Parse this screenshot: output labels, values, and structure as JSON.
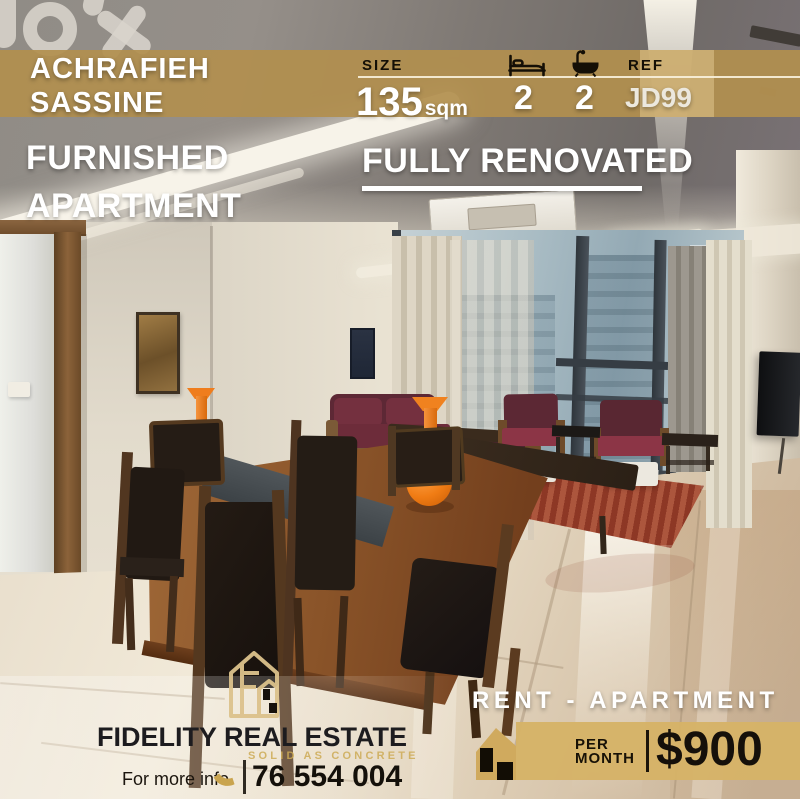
{
  "brand_watermark": "olx",
  "top_banner": {
    "location_line1": "ACHRAFIEH",
    "location_line2": "SASSINE",
    "size_label": "SIZE",
    "size_value": "135",
    "size_unit": "sqm",
    "bedrooms": "2",
    "bathrooms": "2",
    "ref_label": "REF",
    "ref_value": "JD99"
  },
  "listing": {
    "type_line1": "FURNISHED",
    "type_line2": "APARTMENT",
    "highlight": "FULLY RENOVATED"
  },
  "bottom_banner": {
    "category": "RENT - APARTMENT",
    "period_line1": "PER",
    "period_line2": "MONTH",
    "price": "$900"
  },
  "agency": {
    "name": "FIDELITY REAL ESTATE",
    "tagline": "SOLID AS CONCRETE",
    "contact_label": "For more info",
    "phone": "76 554 004"
  },
  "icons": {
    "bedrooms": "bed-icon",
    "bathrooms": "bath-icon",
    "contact": "phone-icon",
    "agency_logo": "house-outline-icon",
    "price_tag": "house-silhouette-icon",
    "watermark": "olx-logo"
  },
  "colors": {
    "top_band_tan": "#b18f4f",
    "price_band_gold": "#d6b367",
    "accent_gold": "#c9a44e",
    "overlay_text_white": "#ffffff",
    "dark_text": "#1b160d",
    "vase_orange": "#f07c14",
    "sofa_maroon": "#5d2835"
  }
}
